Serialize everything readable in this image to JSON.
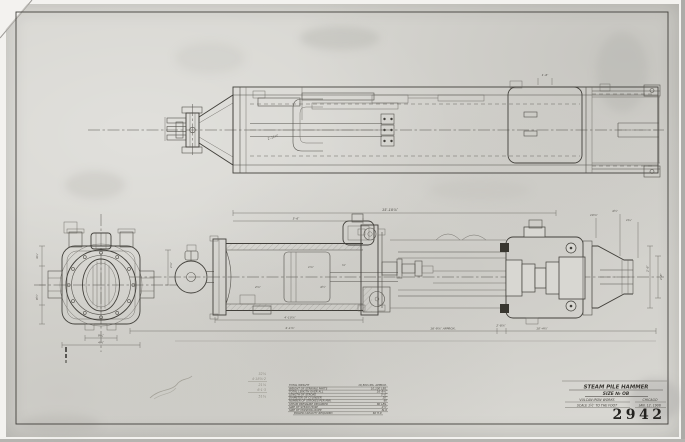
{
  "colors": {
    "ink": "#42403b",
    "paper": "#d8d7d2",
    "margin": "#f3f2ef",
    "pencil": "#8f8d84"
  },
  "title_block": {
    "title": "STEAM PILE HAMMER",
    "size_line": "SIZE № OB",
    "maker": "VULCAN IRON WORKS",
    "city": "CHICAGO",
    "scale": "SCALE 1½″ TO THE FOOT",
    "date": "JAN. 12. 1906",
    "drawing_number": "2942"
  },
  "spec_table": {
    "rows": [
      {
        "label": "TOTAL WEIGHT",
        "value": "16,500 LBS. APPROX."
      },
      {
        "label": "WEIGHT OF STRIKING PARTS",
        "value": "10,100 LBS."
      },
      {
        "label": "TOTAL LENGTH OVER ALL",
        "value": "16′-9½″"
      },
      {
        "label": "LENGTH OF STROKE",
        "value": "5′-0″"
      },
      {
        "label": "DIAMETER OF CYLINDER",
        "value": "20″"
      },
      {
        "label": "NUMBER OF STROKES PER MIN.",
        "value": "60"
      },
      {
        "label": "STEAM PRESSURE REQUIRED",
        "value": "80 LBS."
      },
      {
        "label": "SIZE OF STEAM HOSE",
        "value": "2½″"
      },
      {
        "label": "SIZE OF HOISTING ROPE",
        "value": "№ 6"
      },
      {
        "label": "BOILER CAPACITY REQUIRED",
        "value": "60 H.P."
      }
    ]
  },
  "dims": {
    "sec_overall": "15′-10⅞″",
    "sec_left": "5′-6″",
    "sec_under1": "4′-10⅞″",
    "sec_under2": "4′-1⅞″",
    "overall": "16′-9⅞″ APPROX.",
    "head_w": "2′-8⅞″",
    "nose_w": "10′-4½″",
    "nose_t1": "10⅞″",
    "nose_t2": "4½″",
    "nose_t3": "1¾″",
    "right_v1": "2′-8″",
    "right_v2": "1′-8″",
    "top_small": "1′-6″",
    "top_diag": "2′-11½″",
    "end_l1": "4¼″",
    "end_l2": "8½″",
    "end_r1": "1⅞″",
    "end_b1": "9¾″",
    "end_b2": "4½″",
    "in1": "1⅞″",
    "in2": "4½″",
    "in3": "2⅞″",
    "in4": "⅝″"
  },
  "pencil_notes": {
    "p1": "32⅞",
    "p2": "4·18⅞·2",
    "p3": "21⅞",
    "p4": "6·1·3",
    "p5": "51¾"
  }
}
